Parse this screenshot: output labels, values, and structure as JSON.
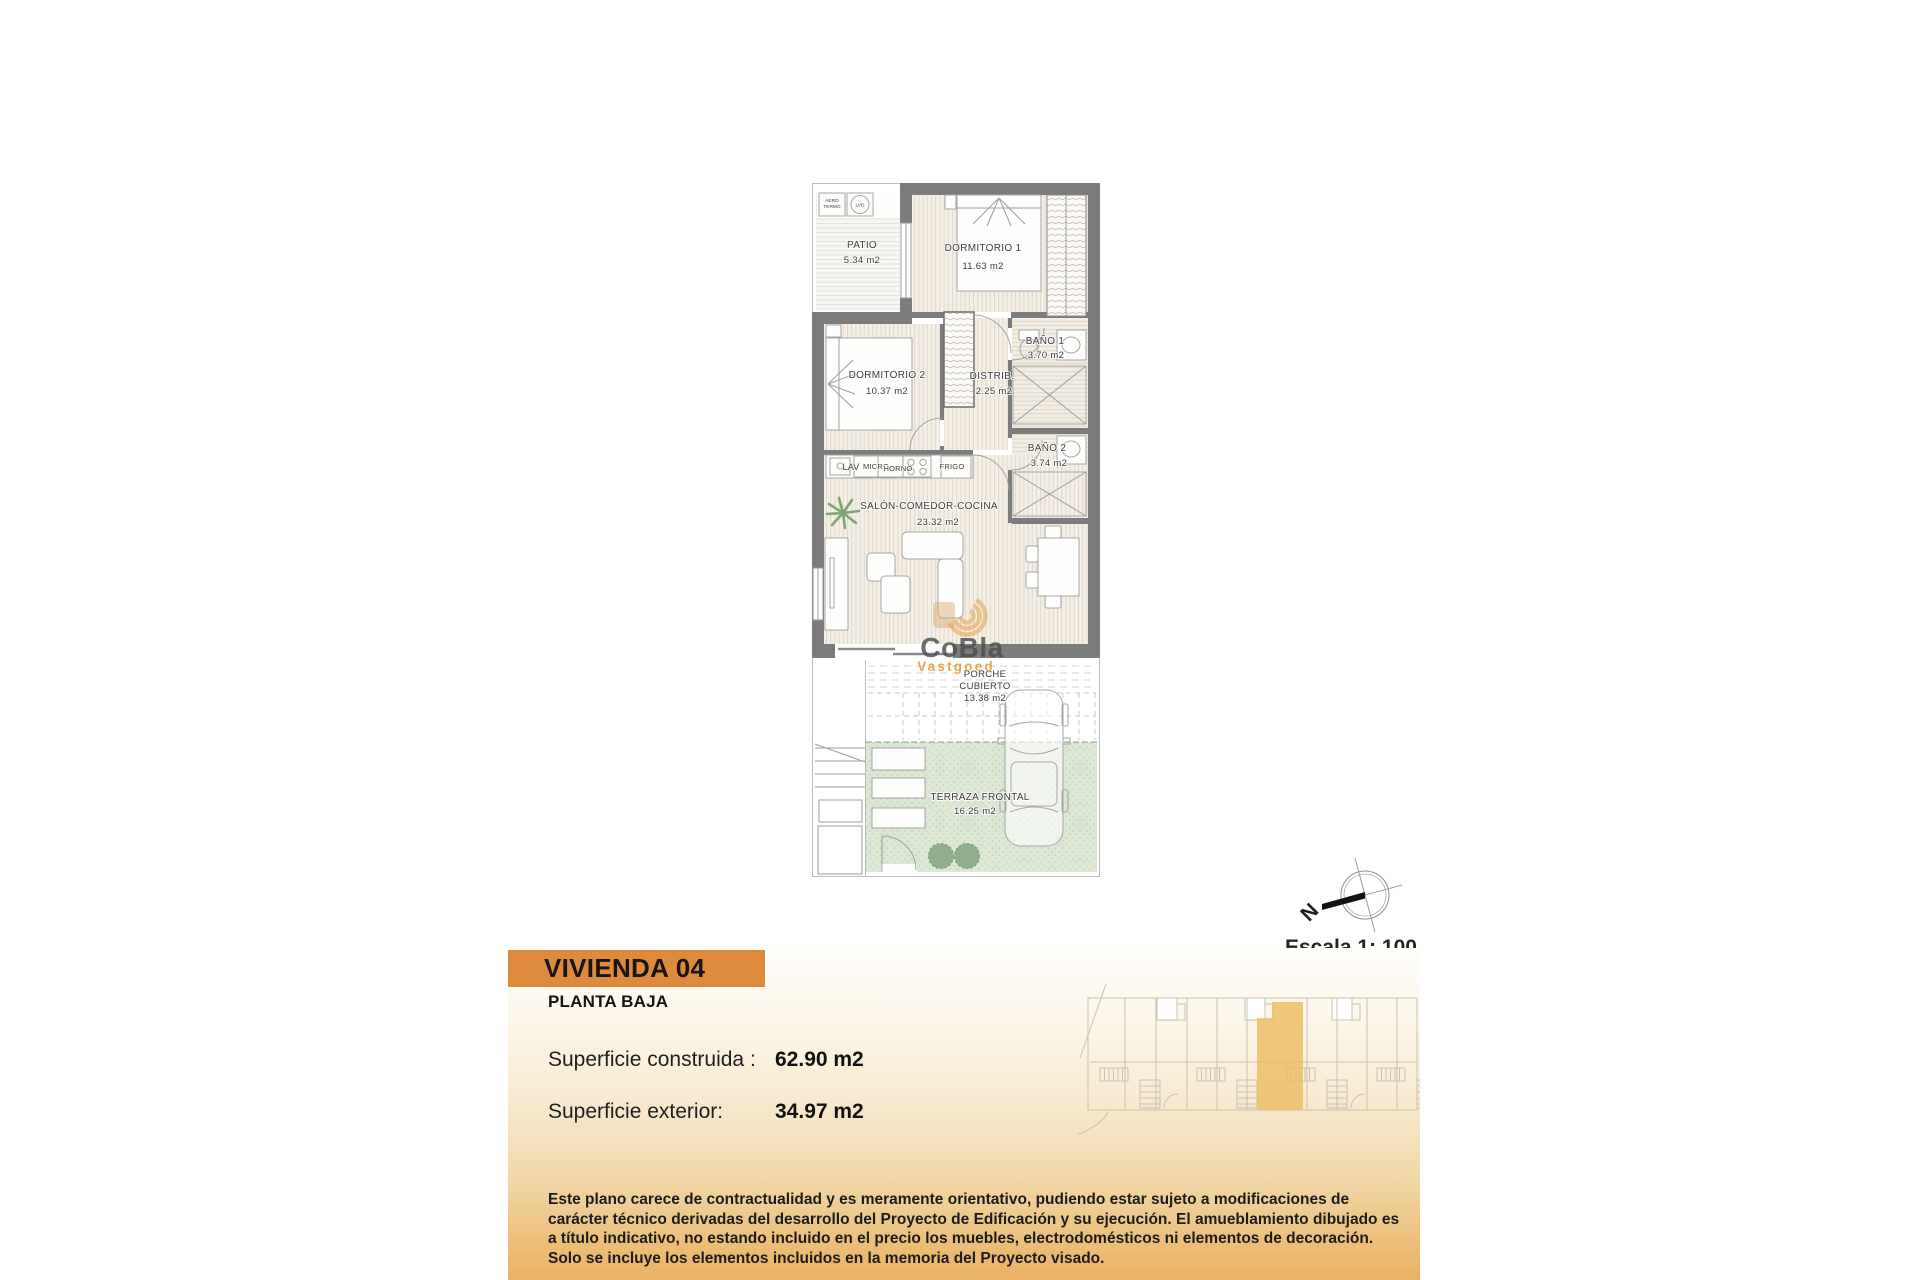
{
  "watermark": {
    "brand": "CoBla",
    "subtitle": "Vastgoed"
  },
  "plan": {
    "rooms": {
      "patio": {
        "name": "PATIO",
        "area": "5.34 m2"
      },
      "dormitorio1": {
        "name": "DORMITORIO 1",
        "area": "11.63 m2"
      },
      "dormitorio2": {
        "name": "DORMITORIO 2",
        "area": "10.37 m2"
      },
      "distribuidor": {
        "name": "DISTRIB.",
        "area": "2.25 m2"
      },
      "bano1": {
        "name": "BAÑO 1",
        "area": "3.70 m2"
      },
      "bano2": {
        "name": "BAÑO 2",
        "area": "3.74 m2"
      },
      "salon": {
        "name": "SALÓN-COMEDOR-COCINA",
        "area": "23.32 m2"
      },
      "porche": {
        "name_line1": "PORCHE",
        "name_line2": "CUBIERTO",
        "area": "13.38 m2"
      },
      "terraza": {
        "name": "TERRAZA FRONTAL",
        "area": "16.25 m2"
      }
    },
    "appliances": {
      "aero_line1": "AERO",
      "aero_line2": "TERMO",
      "lvd": "LVD",
      "lav": "LAV",
      "micro": "MICRO",
      "horno": "HORNO",
      "frigo": "FRIGO"
    }
  },
  "compass": {
    "north": "N"
  },
  "scale": {
    "label": "Escala 1: 100"
  },
  "info": {
    "title": "VIVIENDA 04",
    "floor": "PLANTA BAJA",
    "construida_label": "Superficie construida :",
    "construida_value": "62.90 m2",
    "exterior_label": "Superficie exterior:",
    "exterior_value": "34.97 m2",
    "disclaimer": "Este plano carece de contractualidad y es meramente orientativo, pudiendo estar sujeto a modificaciones de carácter técnico derivadas del desarrollo del Proyecto de Edificación y su ejecución. El amueblamiento dibujado es a título indicativo, no estando incluido en el precio los muebles, electrodomésticos ni elementos de decoración. Solo se incluye los elementos incluidos en la memoria del Proyecto visado."
  },
  "colors": {
    "accent": "#DD8A3C",
    "site_highlight": "#ECBE66",
    "terrace_green": "#DCE7D5",
    "wall_gray": "#7C7C7C"
  }
}
